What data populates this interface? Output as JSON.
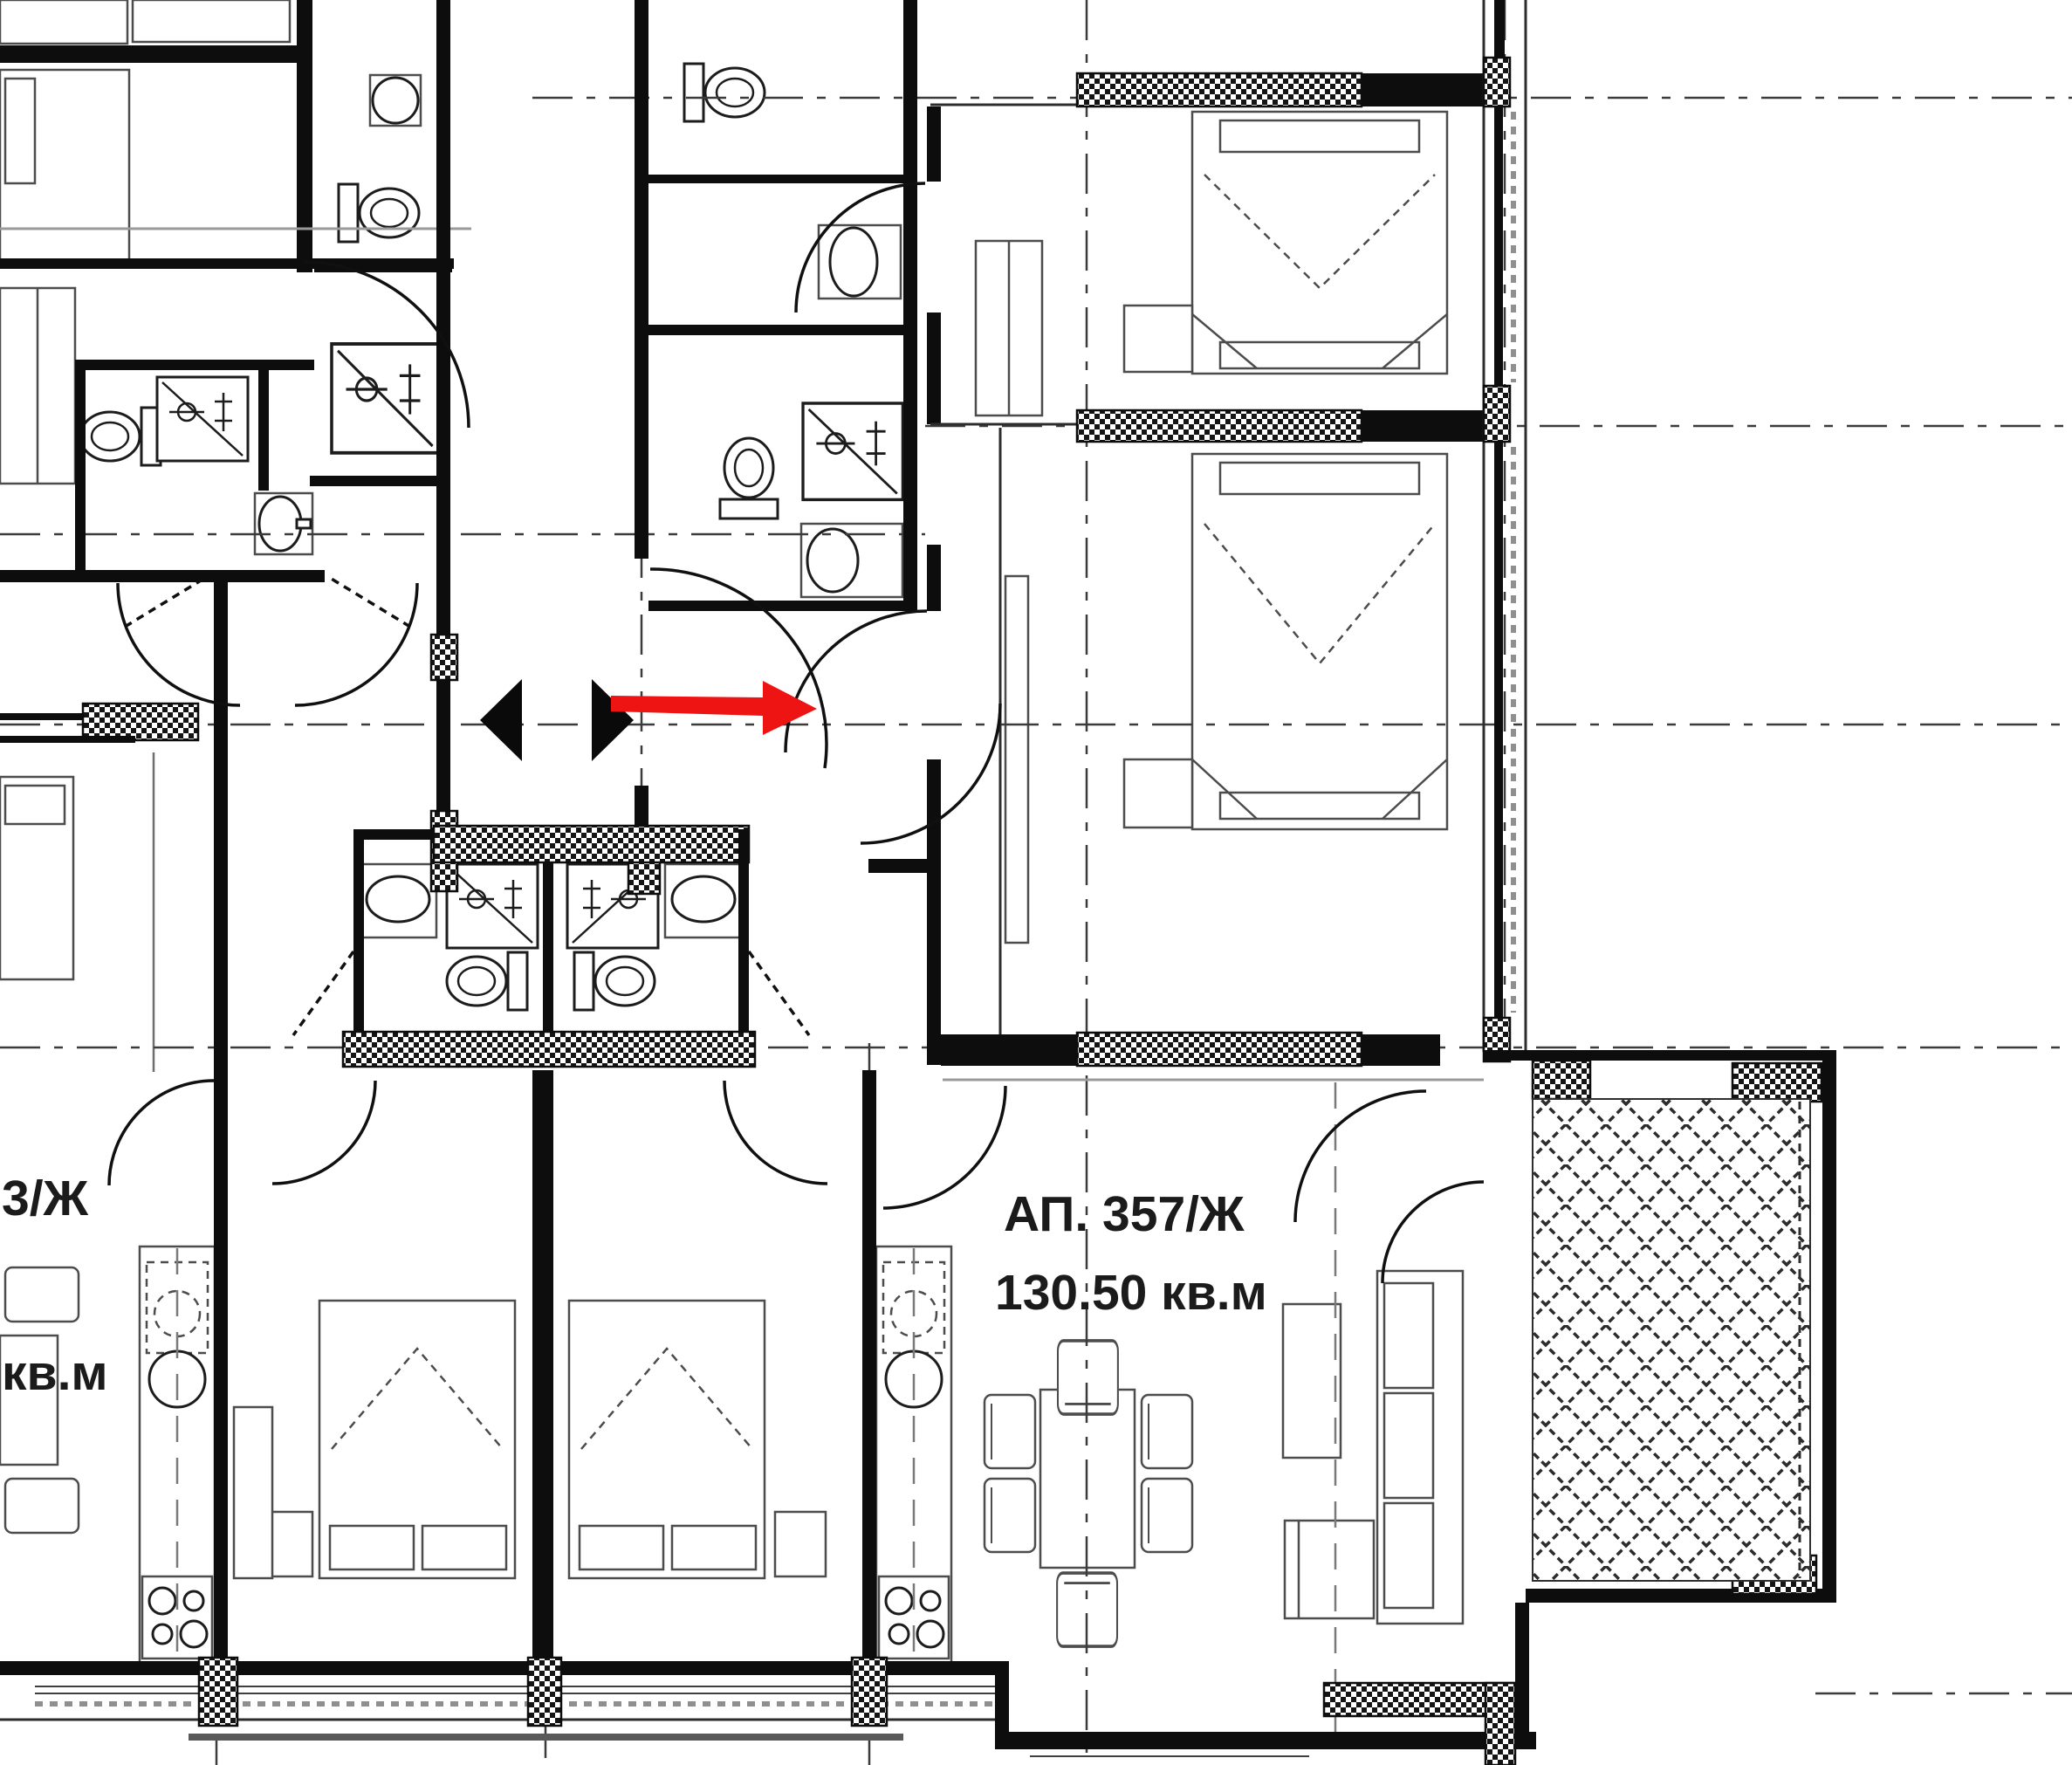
{
  "document": {
    "kind": "architectural floor plan (apartment building, residential storey)",
    "language": "Bulgarian"
  },
  "labels": {
    "apartment_right": {
      "name": "АП. 357/Ж",
      "area": "130.50 кв.м"
    },
    "apartment_left_partial": {
      "name": "3/Ж",
      "area": "кв.м"
    }
  },
  "arrow": {
    "color": "#ee1414",
    "direction": "right",
    "meaning": "entrance direction marker at apartment door"
  },
  "palette": {
    "background": "#ffffff",
    "walls": "#0d0d0d",
    "axis_lines": "#3b3b3b",
    "furniture_lines": "#4c4c4c",
    "window_sill": "#8f8f8f",
    "text": "#1b1b1b"
  }
}
